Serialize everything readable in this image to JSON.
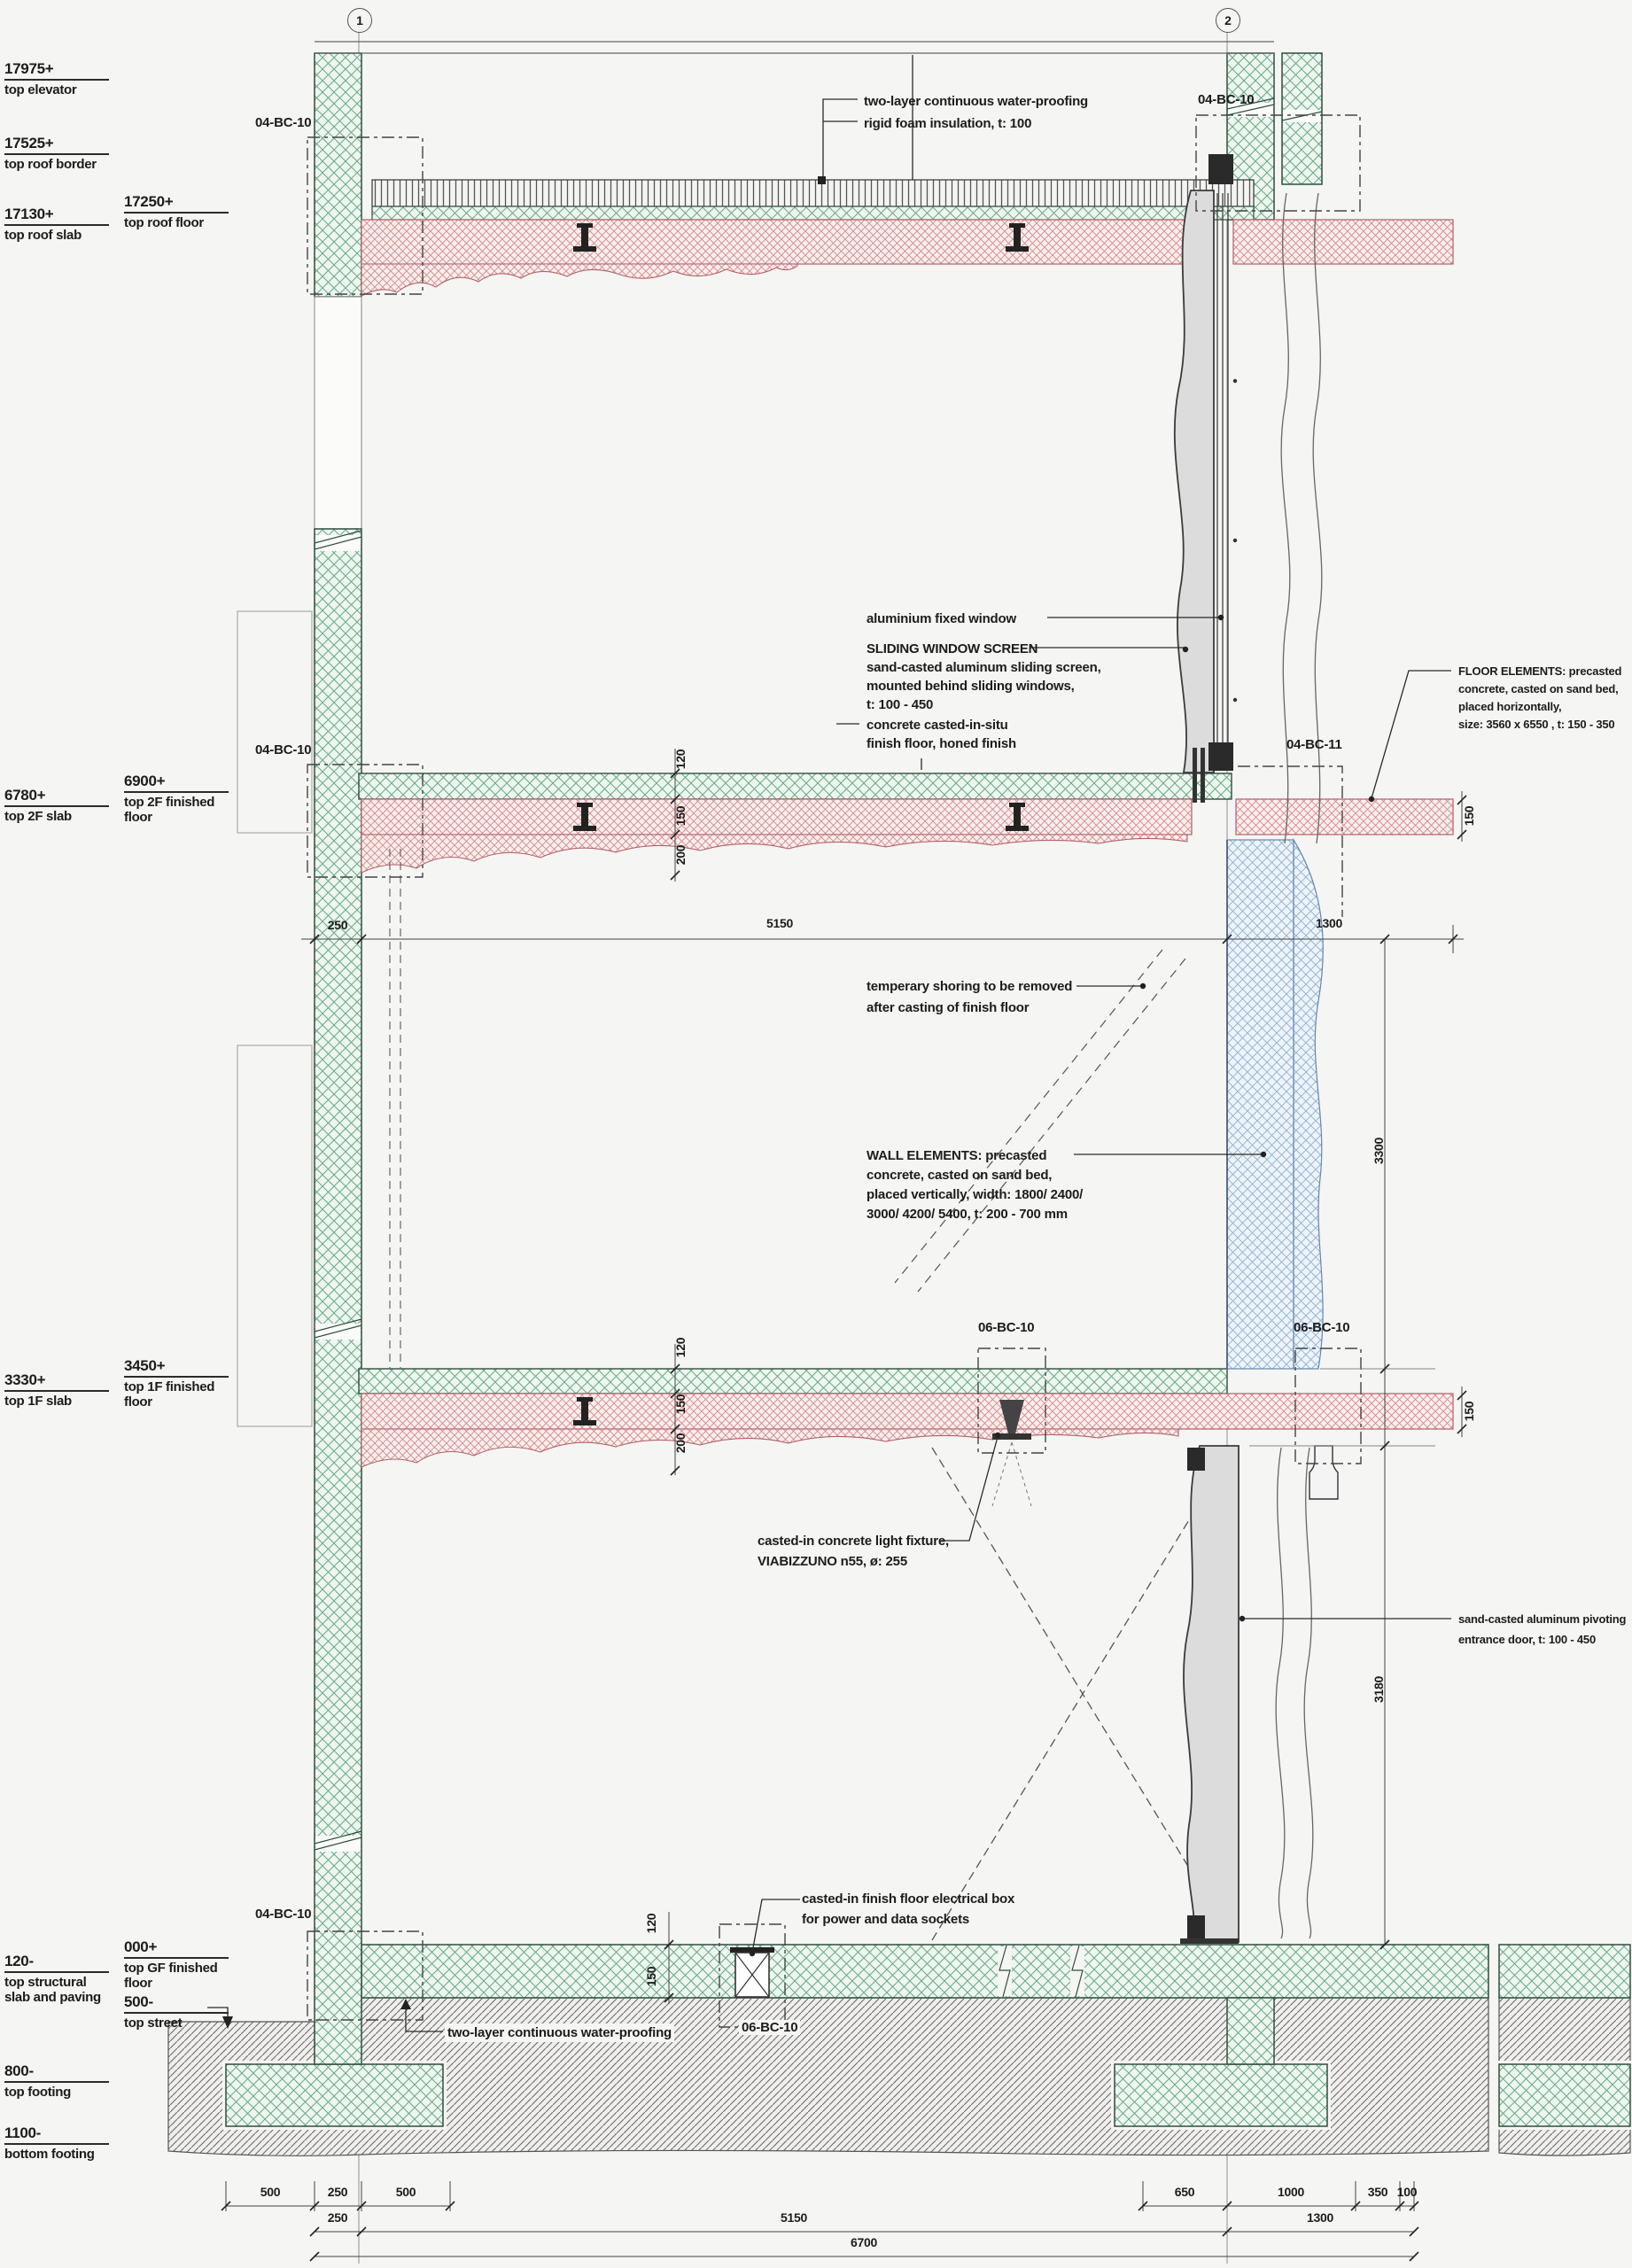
{
  "title": "building facade section detail",
  "grid": {
    "b1": "1",
    "b2": "2"
  },
  "levels": {
    "top_elevator": {
      "v": "17975+",
      "l": "top elevator"
    },
    "top_roof_border": {
      "v": "17525+",
      "l": "top roof border"
    },
    "top_roof_floor": {
      "v": "17250+",
      "l": "top roof floor"
    },
    "top_roof_slab": {
      "v": "17130+",
      "l": "top roof slab"
    },
    "top_2f_finished": {
      "v": "6900+",
      "l": "top 2F finished floor"
    },
    "top_2f_slab": {
      "v": "6780+",
      "l": "top 2F slab"
    },
    "top_1f_finished": {
      "v": "3450+",
      "l": "top 1F finished floor"
    },
    "top_1f_slab": {
      "v": "3330+",
      "l": "top 1F slab"
    },
    "top_gf_finished": {
      "v": "000+",
      "l": "top GF finished floor"
    },
    "top_structural": {
      "v": "120-",
      "l": "top structural slab and paving"
    },
    "top_street": {
      "v": "500-",
      "l": "top street"
    },
    "top_footing": {
      "v": "800-",
      "l": "top footing"
    },
    "bottom_footing": {
      "v": "1100-",
      "l": "bottom footing"
    }
  },
  "refs": {
    "r04bc10": "04-BC-10",
    "r04bc11": "04-BC-11",
    "r06bc10": "06-BC-10"
  },
  "ann": {
    "wp1": "two-layer continuous water-proofing",
    "wp2": "rigid foam insulation, t: 100",
    "alu": "aluminium fixed window",
    "sws_t": "SLIDING WINDOW SCREEN",
    "sws1": "sand-casted aluminum sliding screen,",
    "sws2": "mounted behind sliding windows,",
    "sws3": "t: 100 - 450",
    "situ1": "concrete casted-in-situ",
    "situ2": "finish floor, honed finish",
    "fe1": "FLOOR ELEMENTS: precasted",
    "fe2": "concrete, casted on sand bed,",
    "fe3": "placed horizontally,",
    "fe4": "size: 3560 x 6550 , t: 150 - 350",
    "sh1": "temperary shoring to be removed",
    "sh2": "after casting of finish floor",
    "we1": "WALL ELEMENTS: precasted",
    "we2": "concrete, casted on sand bed,",
    "we3": "placed vertically, width: 1800/ 2400/",
    "we4": "3000/ 4200/ 5400, t: 200 - 700 mm",
    "lf1": "casted-in concrete light fixture,",
    "lf2": "VIABIZZUNO n55, ø: 255",
    "dr1": "sand-casted aluminum pivoting",
    "dr2": "entrance door, t: 100 - 450",
    "eb1": "casted-in finish floor electrical box",
    "eb2": "for power and data sockets",
    "wpb": "two-layer continuous water-proofing"
  },
  "dims": {
    "d100": "100",
    "d120": "120",
    "d150": "150",
    "d200": "200",
    "d250": "250",
    "d350": "350",
    "d500": "500",
    "d650": "650",
    "d1000": "1000",
    "d1300": "1300",
    "d3180": "3180",
    "d3300": "3300",
    "d5150": "5150",
    "d6700": "6700"
  },
  "colors": {
    "green_hatch": "#69a886",
    "red_hatch": "#d28a8e",
    "blue_hatch": "#8fb0cf",
    "earth_hatch": "#6b6b6b",
    "panel_gray": "#dcdcdc",
    "line": "#3a3a3a"
  }
}
